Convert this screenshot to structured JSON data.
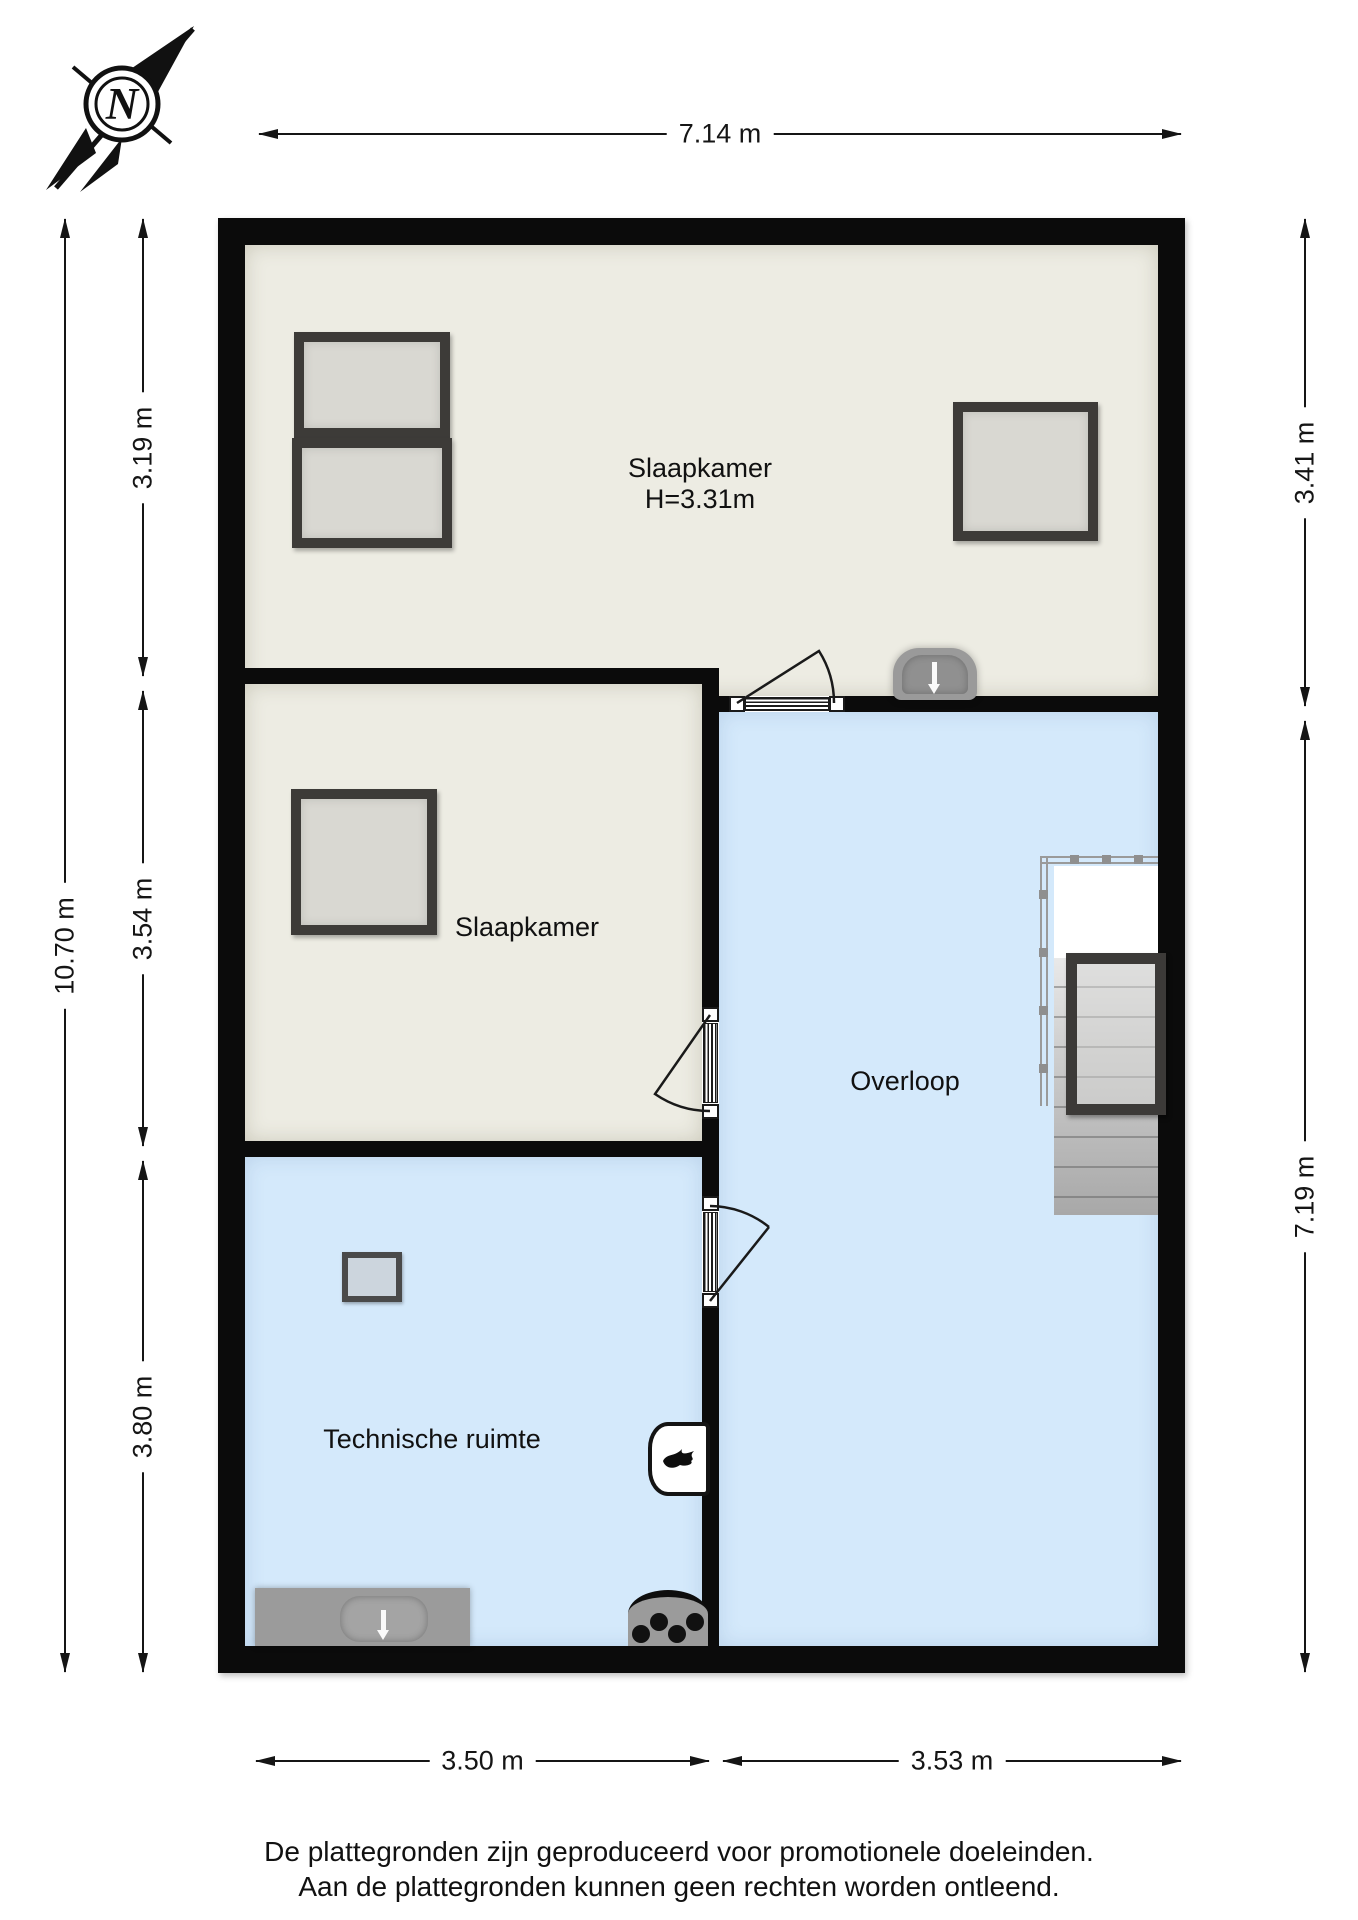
{
  "compass": {
    "letter": "N"
  },
  "dimensions": {
    "top": "7.14 m",
    "left_total": "10.70 m",
    "left_top": "3.19 m",
    "left_mid": "3.54 m",
    "left_bottom": "3.80 m",
    "right_top": "3.41 m",
    "right_bottom": "7.19 m",
    "bottom_left": "3.50 m",
    "bottom_right": "3.53 m"
  },
  "rooms": {
    "slaapkamer_top": {
      "label": "Slaapkamer",
      "height": "H=3.31m"
    },
    "slaapkamer_mid": {
      "label": "Slaapkamer"
    },
    "overloop": {
      "label": "Overloop"
    },
    "technische_ruimte": {
      "label": "Technische ruimte"
    }
  },
  "colors": {
    "wall": "#0b0b0b",
    "room_beige": "#edece3",
    "room_blue": "#d4e9fb",
    "window_frame": "#3d3b38",
    "window_glass": "#d9d8d2",
    "fixture_gray": "#9b9b9b"
  },
  "footer": {
    "line1": "De plattegronden zijn geproduceerd voor promotionele doeleinden.",
    "line2": "Aan de plattegronden kunnen geen rechten worden ontleend."
  }
}
